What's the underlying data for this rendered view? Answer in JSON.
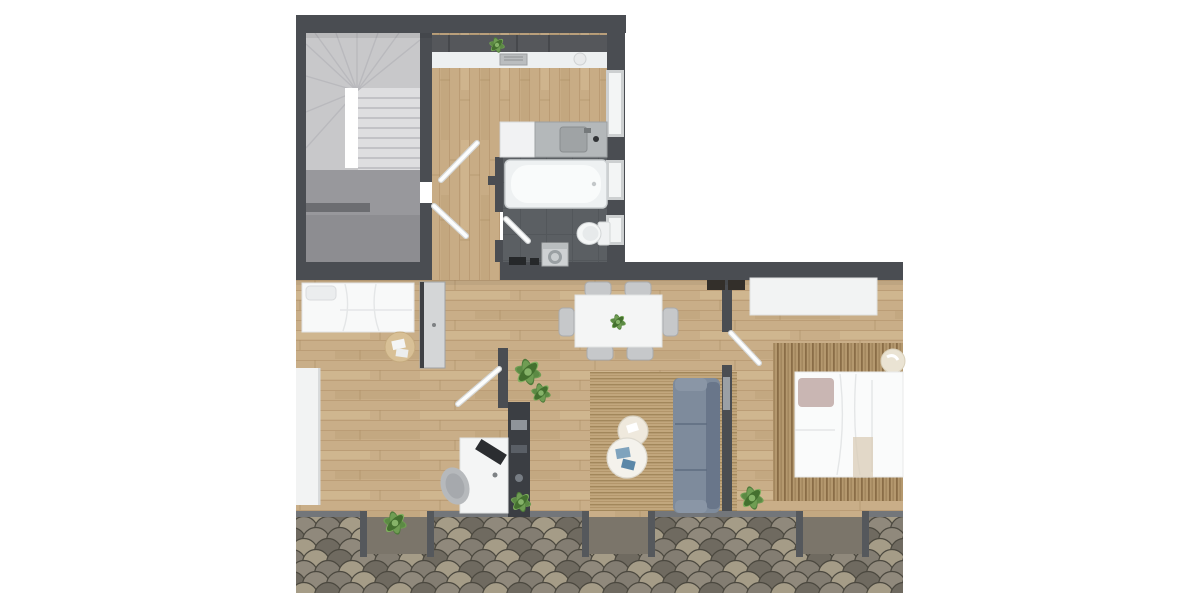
{
  "meta": {
    "title": "Top-down 3D rendered floor plan of an attic apartment",
    "view": "top-down architectural render",
    "background": "#ffffff",
    "visible_text": "none"
  },
  "colors": {
    "wall": "#4a4d52",
    "wallLight": "#73767a",
    "post": "#55585c",
    "stairUpper": "#c8c8ca",
    "stairTread": "#dedee0",
    "stairLine": "#b9b9bd",
    "landing": "#98989c",
    "landingDark": "#8d8d91",
    "handrail": "#6c6d71",
    "wood": "#c9ae88",
    "woodLine": "#b3946c",
    "tile": "#5b5f63",
    "tileLine": "#53575b",
    "furnitureWhite": "#f3f4f4",
    "steel": "#b4b8ba",
    "chair": "#c6c8ca",
    "wardrobe": "#d4d6d7",
    "sofa": "#7e8b9c",
    "sofaDark": "#69768a",
    "rug": "#c2a77d",
    "rugStripe": "#a2875b",
    "rug2": "#b4986e",
    "rug2Stripe": "#8a6d47",
    "bed": "#fafbfb",
    "pillowMauve": "#c9b6b3",
    "throw": "#d9ccb7",
    "plant": "#6f9d53",
    "plantDark": "#4e7a3a",
    "appliance": "#26282a",
    "darkUnit": "#3b3e43",
    "roofA": "#837d72",
    "roofB": "#90897c",
    "roofC": "#6f6a60",
    "roofD": "#a59c87",
    "roofLine": "#4b483f"
  },
  "rooms": [
    {
      "id": "staircase",
      "label": "Staircase with winder stairs, stairwell void and lower landing with handrail"
    },
    {
      "id": "hallway",
      "label": "Hallway corridor with three interior doors"
    },
    {
      "id": "kitchen",
      "label": "Kitchen with wall counter, upper cabinets, plant, tray and plate"
    },
    {
      "id": "bathroom",
      "label": "Bathroom with vanity sink counter, bathtub, toilet, washing machine, dark tile floor, three windows"
    },
    {
      "id": "bedroom-1",
      "label": "Bedroom with double bed, white pillow, wardrobe, round jute mat and wall desk shelf"
    },
    {
      "id": "living-dining",
      "label": "Open living-dining room with six-chair dining table, striped area rug, two round coffee tables, grey sofa, dark media sideboard and potted plants"
    },
    {
      "id": "office-nook",
      "label": "Office nook with white desk, monitor and swivel chair"
    },
    {
      "id": "bedroom-2",
      "label": "Second bedroom with double bed, mauve pillow, striped rug, white dresser, pouf and plant"
    },
    {
      "id": "roof",
      "label": "Fish-scale shingle roof with three dormer window recesses"
    }
  ],
  "furniture": [
    "winder-stairs",
    "handrail",
    "kitchen-counter",
    "upper-cabinets",
    "vanity-sink",
    "bathtub",
    "toilet",
    "washing-machine",
    "double-bed-1",
    "wardrobe",
    "bedside-mat",
    "wall-desk-shelf",
    "dining-table",
    "dining-chairs-x6",
    "area-rug-living",
    "coffee-table-small",
    "coffee-table-large",
    "sofa",
    "media-sideboard",
    "office-desk",
    "monitor",
    "office-chair",
    "dresser",
    "area-rug-bedroom",
    "double-bed-2",
    "pouf",
    "potted-plants-x6",
    "dormer-windows-x3"
  ],
  "counts": {
    "dormers": 3,
    "bathroom_windows": 3,
    "dining_chairs": 6,
    "coffee_tables": 2,
    "beds": 2,
    "plants": 7
  }
}
